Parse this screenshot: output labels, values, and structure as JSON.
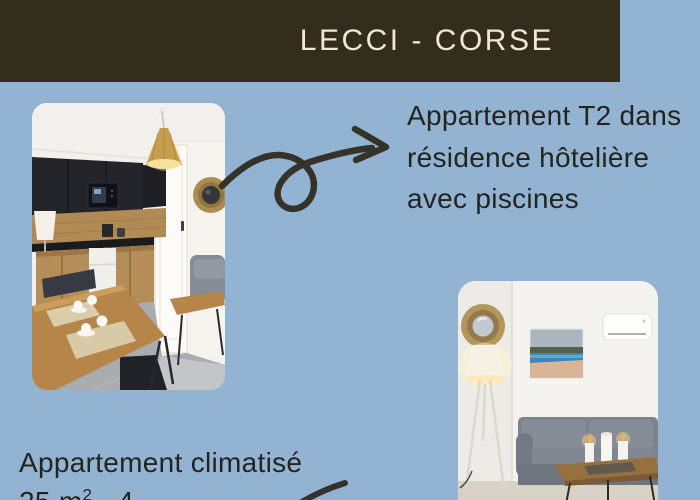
{
  "colors": {
    "background": "#92b4d2",
    "header_bg": "#332d1e",
    "header_text": "#efe8d8",
    "body_text": "#25231d",
    "arrow": "#35322a"
  },
  "header": {
    "title": "LECCI - CORSE"
  },
  "headline": {
    "lines": [
      "Appartement T2 dans",
      "résidence hôtelière",
      "avec piscines"
    ]
  },
  "details": {
    "line1": "Appartement climatisé",
    "area_prefix": "25 m",
    "area_sup": "2",
    "area_suffix": " - 4"
  },
  "photos": [
    {
      "name": "kitchen-dining-photo",
      "description": "Kitchenette with black upper cabinets and microwave, wooden worktop and lower cabinets, white mini fridge, rattan pendant lamp, white door with round raffia mirror, wooden dining table with coffee cups and placemats"
    },
    {
      "name": "living-room-photo",
      "description": "Living room with round raffia mirror, lit tripod floor lamp, beach picture on wall, air-conditioning unit, grey sofa and wooden coffee table with candles"
    }
  ],
  "decorations": {
    "curly_arrow": "hand-drawn curly arrow pointing from kitchen photo to headline",
    "partial_arrow": "hand-drawn arrow partially visible at bottom edge"
  }
}
